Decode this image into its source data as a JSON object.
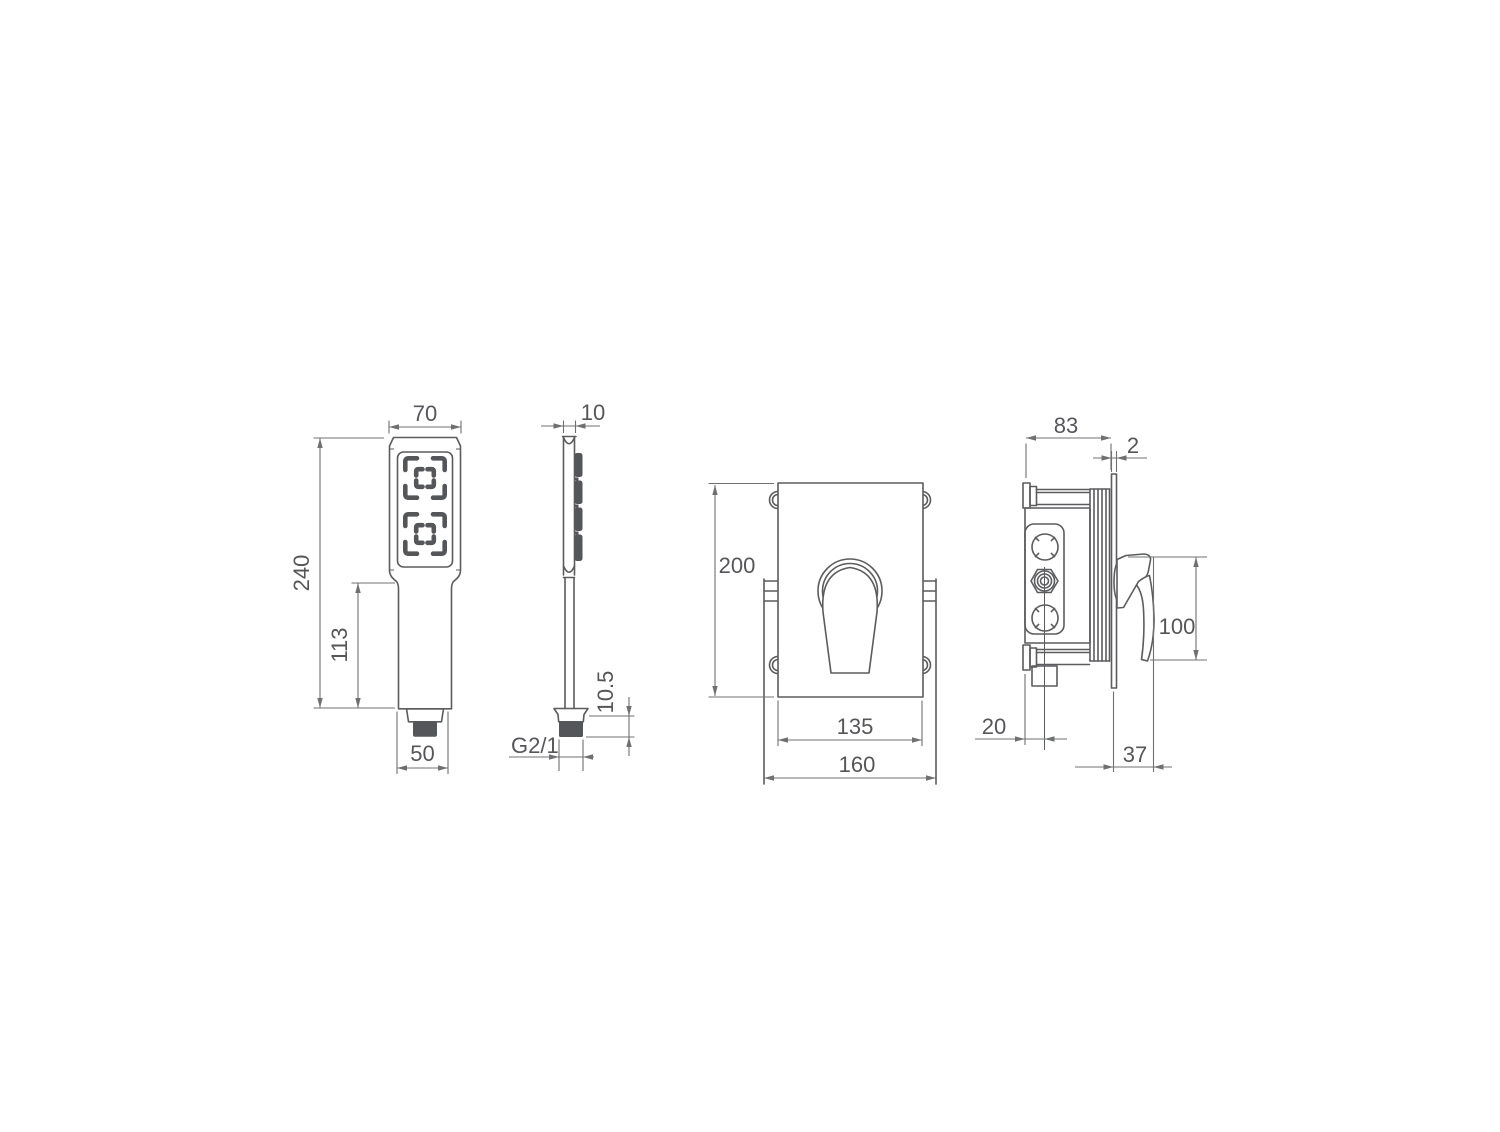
{
  "drawing": {
    "background": "#ffffff",
    "line_color": "#5b5c5e",
    "dim_line_color": "#6f7072",
    "text_color": "#55565a",
    "dark_fill": "#55565a",
    "views": {
      "hand_shower_front": {
        "name": "hand shower front view",
        "dims": {
          "head_width": "70",
          "total_height": "240",
          "handle_length": "113",
          "handle_width": "50"
        }
      },
      "hand_shower_side": {
        "name": "hand shower side view",
        "dims": {
          "thickness": "10",
          "connector_height": "10.5",
          "thread": "G2/1"
        }
      },
      "mixer_front": {
        "name": "concealed mixer front view",
        "dims": {
          "plate_height": "200",
          "plate_width": "135",
          "box_width": "160"
        }
      },
      "mixer_side": {
        "name": "concealed mixer side view",
        "dims": {
          "body_depth": "83",
          "plate_thickness": "2",
          "handle_height": "100",
          "outlet_offset": "20",
          "handle_projection": "37"
        }
      }
    }
  }
}
